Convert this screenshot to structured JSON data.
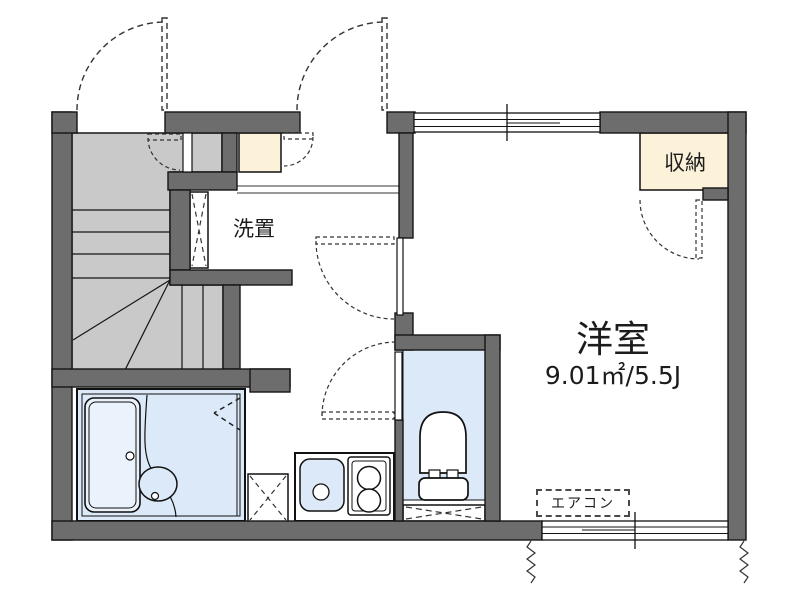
{
  "floorplan": {
    "labels": {
      "washer_storage": "洗置",
      "closet": "収納",
      "main_room_name": "洋室",
      "main_room_area": "9.01㎡/5.5J",
      "air_conditioner": "エアコン"
    },
    "colors": {
      "wall": "#6d6d6d",
      "stairs": "#c9c9c9",
      "wet_area": "#dce9f8",
      "bathtub": "#eaf2fb",
      "closet_fill": "#fcf2da",
      "background": "#ffffff",
      "line": "#1c1c1c"
    }
  }
}
